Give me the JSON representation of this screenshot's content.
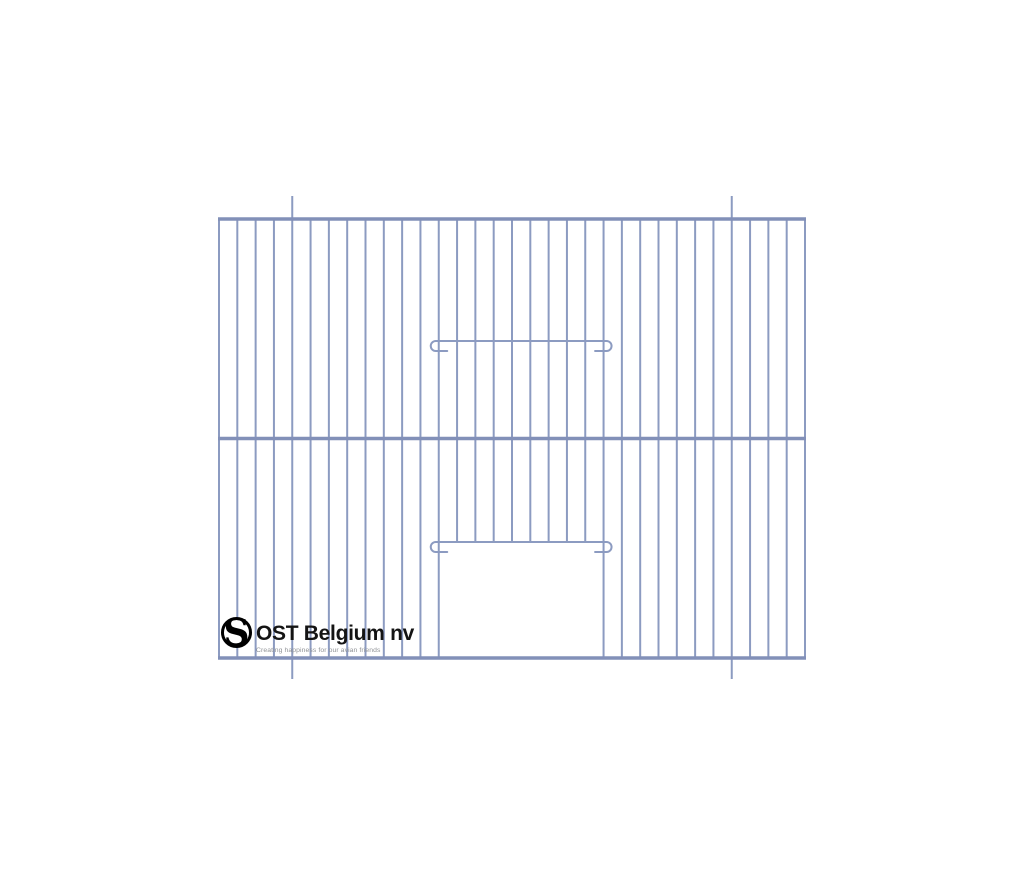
{
  "canvas": {
    "width": 1024,
    "height": 878,
    "background": "#ffffff"
  },
  "cage_front": {
    "wire_color": "#8c9bc1",
    "frame_color": "#8290b8",
    "wire_width": 2,
    "frame_width": 3.4,
    "panel": {
      "left": 219,
      "top": 219,
      "right": 805,
      "bottom": 658
    },
    "crossbar_y": 438.5,
    "vertical_wire_count": 33,
    "hanging_wires": {
      "indices": [
        4,
        28
      ],
      "top_overhang": 23,
      "bottom_overhang": 21
    },
    "doors": {
      "left_wire_index": 12,
      "right_wire_index": 21,
      "open_door_missing_wires": {
        "from_index": 13,
        "to_index": 20
      },
      "open_door_wires_end_y": 542,
      "latches": {
        "top_y": 341,
        "bottom_y": 542,
        "hook_radius": 5,
        "hook_overhang": 3,
        "tail_length": 11.5,
        "drop": 10
      }
    }
  },
  "logo": {
    "monogram_letter": "S",
    "title": "OST Belgium nv",
    "tagline": "Creating happiness for our avian friends",
    "ring_color": "#000000",
    "title_color": "#141414",
    "tagline_color": "#8f9296"
  }
}
